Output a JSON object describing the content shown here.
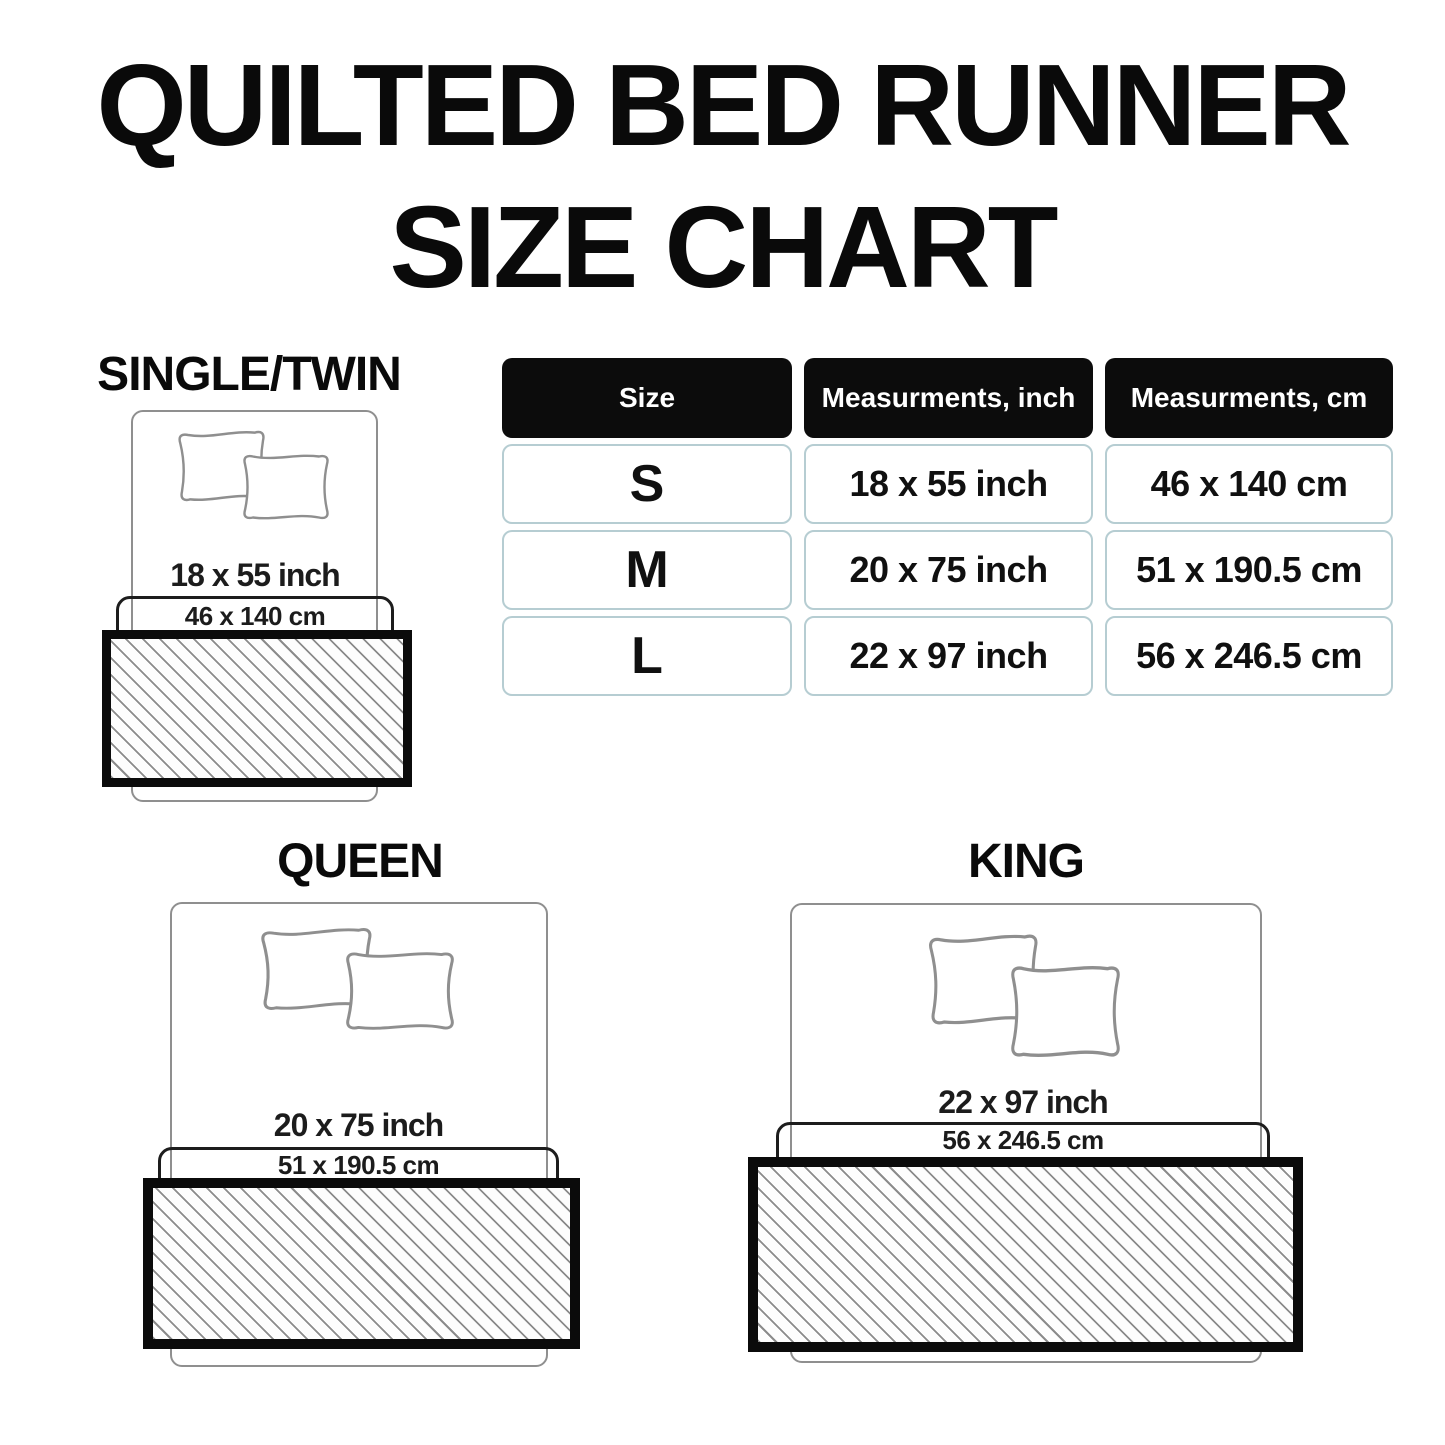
{
  "chart_data": {
    "type": "table",
    "title": "QUILTED BED RUNNER SIZE CHART",
    "columns": [
      "Size",
      "Measurments, inch",
      "Measurments, cm"
    ],
    "rows": [
      [
        "S",
        "18 x 55 inch",
        "46 x 140 cm"
      ],
      [
        "M",
        "20 x 75 inch",
        "51 x 190.5 cm"
      ],
      [
        "L",
        "22 x 97 inch",
        "56 x 246.5 cm"
      ]
    ]
  },
  "title": {
    "line1": "QUILTED BED RUNNER",
    "line2": "SIZE CHART"
  },
  "table": {
    "headers": {
      "size": "Size",
      "inch": "Measurments, inch",
      "cm": "Measurments, cm"
    },
    "rows": [
      {
        "size": "S",
        "inch": "18 x 55 inch",
        "cm": "46 x 140 cm"
      },
      {
        "size": "M",
        "inch": "20 x 75 inch",
        "cm": "51 x 190.5 cm"
      },
      {
        "size": "L",
        "inch": "22 x 97 inch",
        "cm": "56 x 246.5 cm"
      }
    ]
  },
  "diagrams": {
    "single": {
      "label": "SINGLE/TWIN",
      "inch": "18 x 55 inch",
      "cm": "46 x 140 cm"
    },
    "queen": {
      "label": "QUEEN",
      "inch": "20 x 75 inch",
      "cm": "51 x 190.5 cm"
    },
    "king": {
      "label": "KING",
      "inch": "22 x 97 inch",
      "cm": "56 x 246.5 cm"
    }
  },
  "colors": {
    "header_black": "#0c0c0c",
    "cell_border": "#b6cdd2",
    "bed_outline_gray": "#8f8f8f",
    "hatch_gray": "#8b8b8b",
    "runner_border_black": "#0b0b0b",
    "text_dark": "#1c1c1c"
  }
}
